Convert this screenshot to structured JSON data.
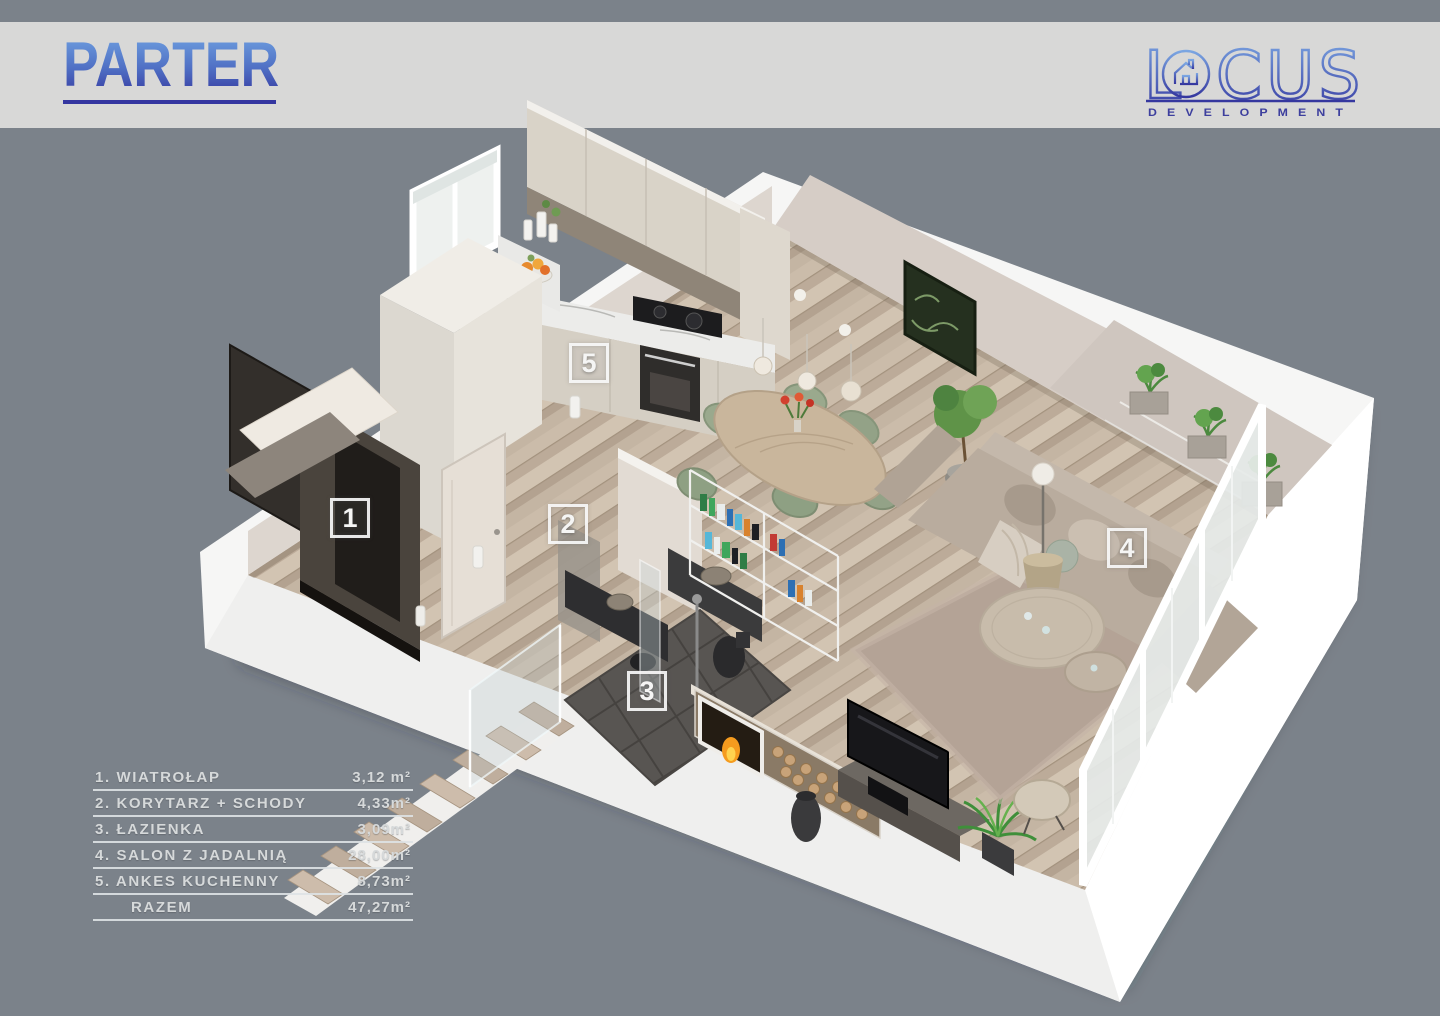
{
  "header": {
    "title": "PARTER"
  },
  "logo": {
    "l": "L",
    "rest": "CUS",
    "sub": "DEVELOPMENT"
  },
  "markers": [
    {
      "label": "1"
    },
    {
      "label": "2"
    },
    {
      "label": "3"
    },
    {
      "label": "4"
    },
    {
      "label": "5"
    }
  ],
  "legend": {
    "rows": [
      {
        "label": "1. WIATROŁAP",
        "area": "3,12 m²"
      },
      {
        "label": "2. KORYTARZ + SCHODY",
        "area": "4,33m²"
      },
      {
        "label": "3. ŁAZIENKA",
        "area": "3,09m²"
      },
      {
        "label": "4. SALON Z JADALNIĄ",
        "area": "28,00m²"
      },
      {
        "label": "5. ANKES KUCHENNY",
        "area": "8,73m²"
      },
      {
        "label": "RAZEM",
        "area": "47,27m²"
      }
    ]
  },
  "colors": {
    "background": "#7b828a",
    "header_band": "#d8d8d7",
    "accent_blue_top": "#6fa0e0",
    "accent_blue_bottom": "#35379f",
    "logo_blue": "#3d3f9e",
    "wall_white": "#f6f6f5",
    "inner_wall": "#d6cdc6",
    "floor_wood": "#c6b7a5",
    "bath_tile": "#585552",
    "legend_text": "#d6d9da",
    "marker_white": "#f5f5f4"
  }
}
